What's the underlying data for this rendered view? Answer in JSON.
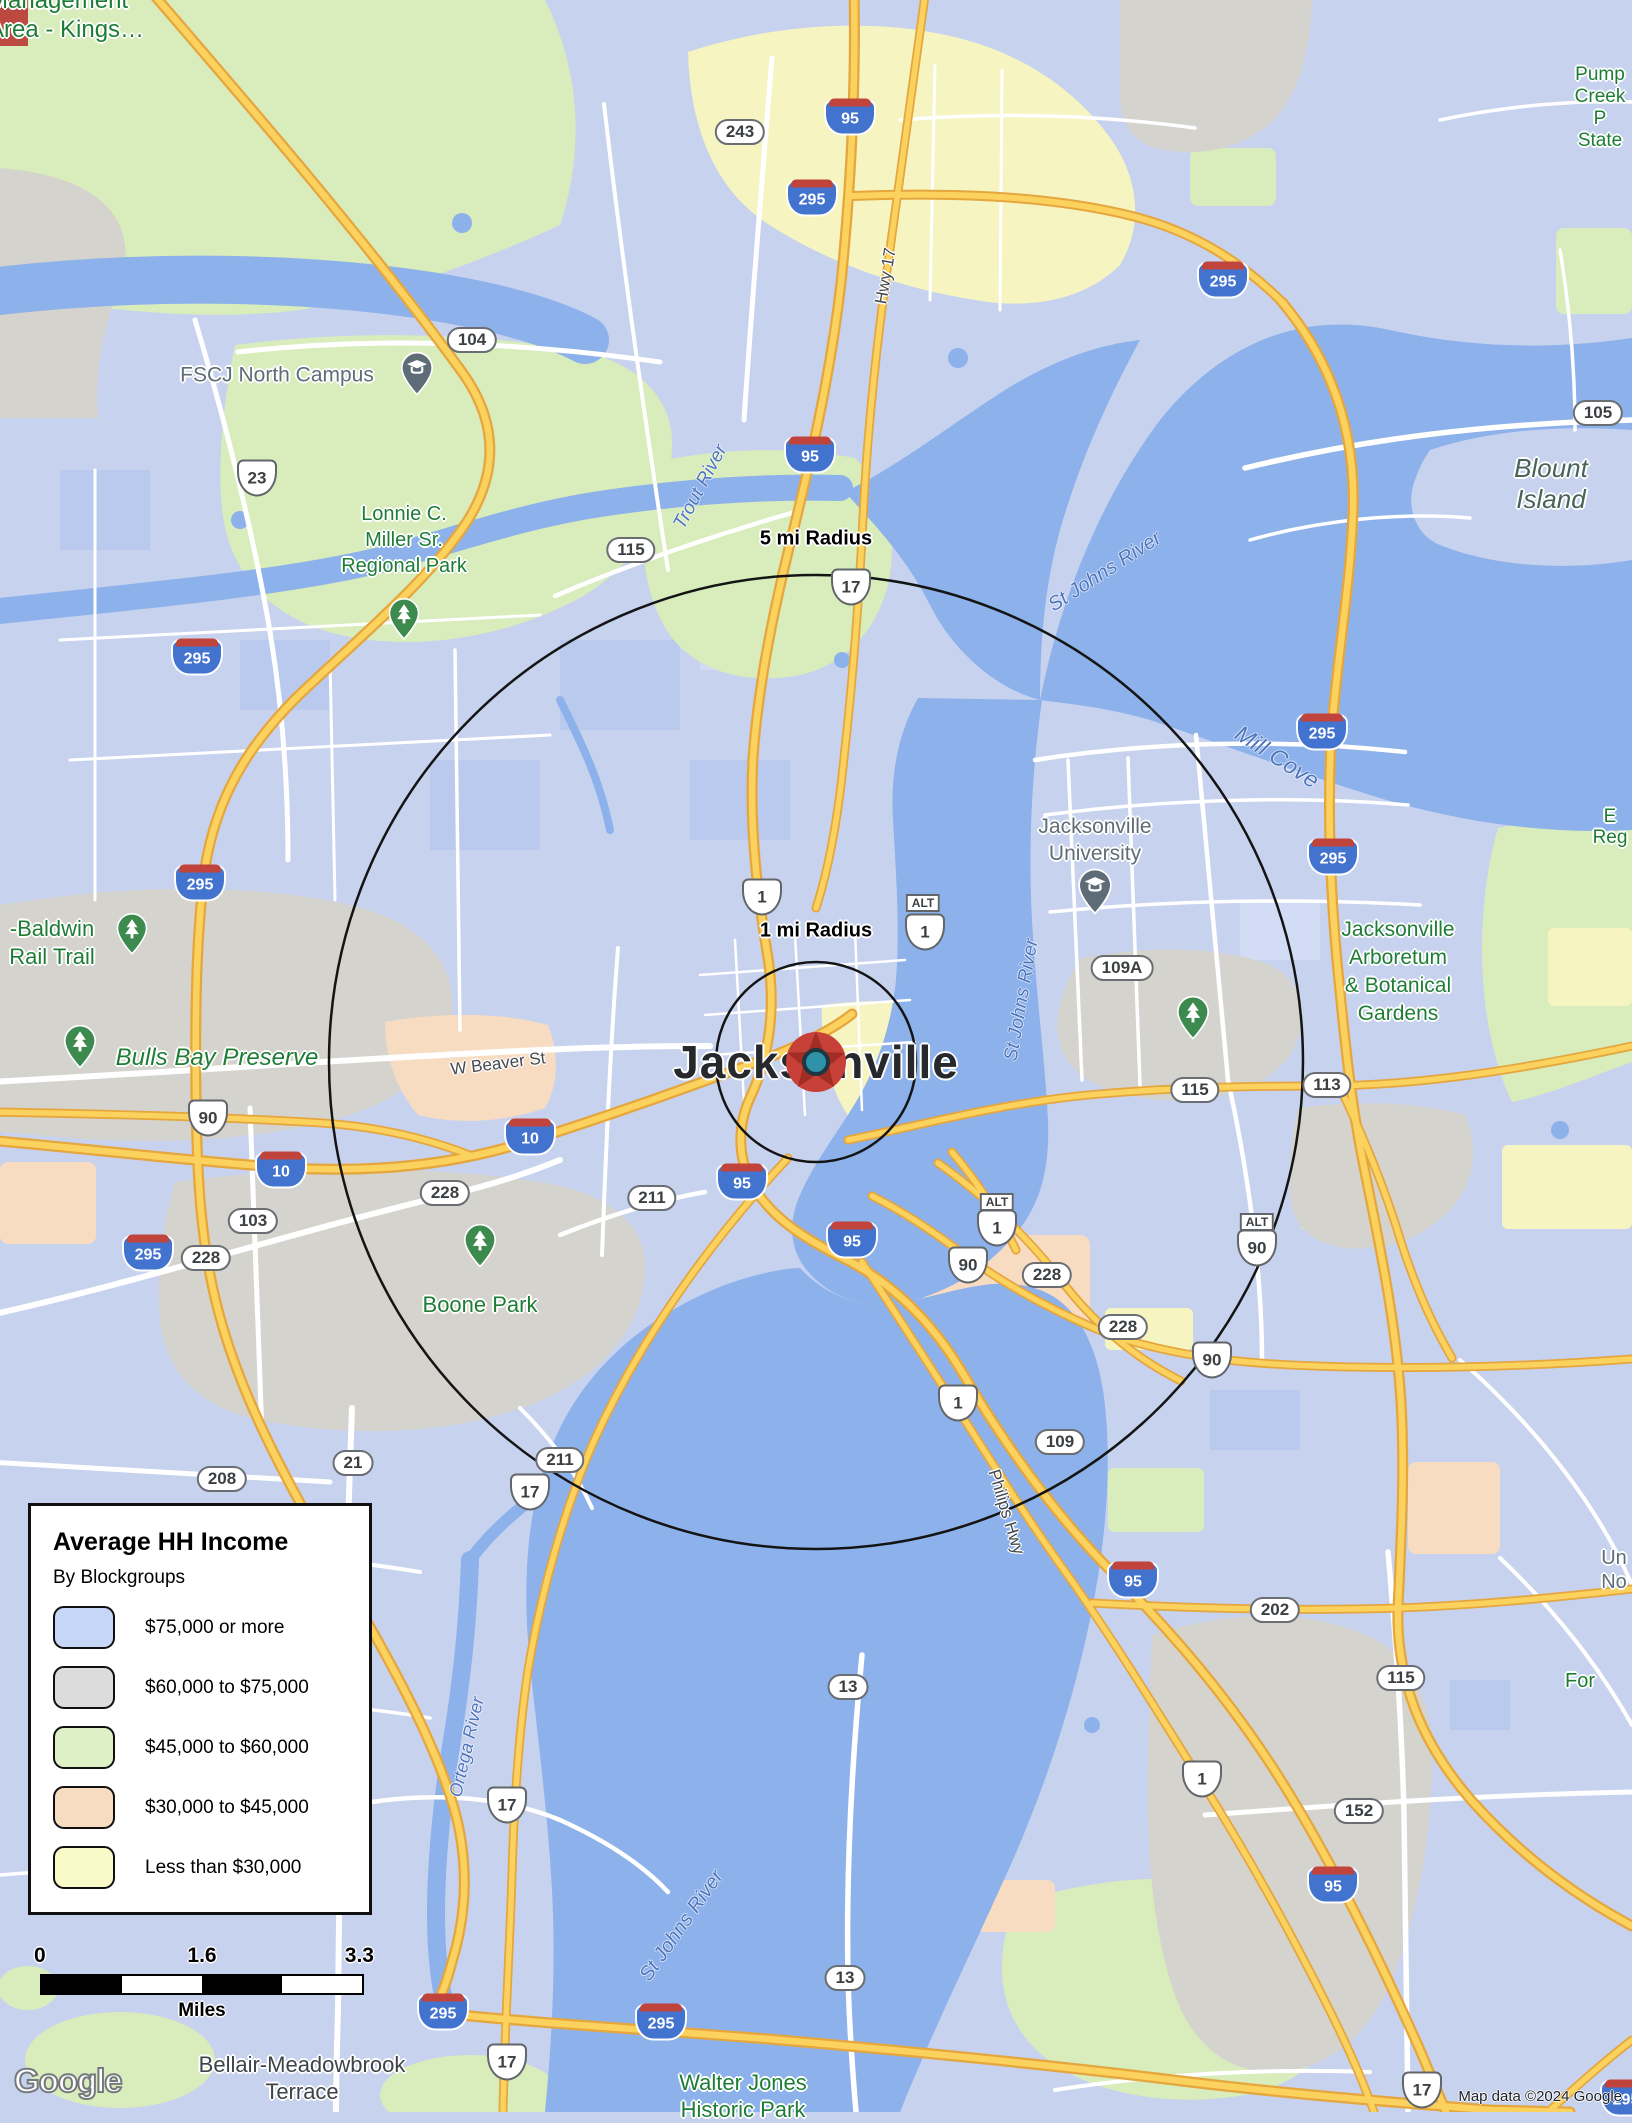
{
  "legend": {
    "title": "Average HH Income",
    "subtitle": "By Blockgroups",
    "items": [
      {
        "label": "$75,000 or more",
        "swatch_css": "background:#c5d6f7"
      },
      {
        "label": "$60,000 to $75,000",
        "swatch_css": "background:#dcdcdc"
      },
      {
        "label": "$45,000 to $60,000",
        "swatch_css": "background:#def0c6"
      },
      {
        "label": "$30,000 to $45,000",
        "swatch_css": "background:#f8dcc1"
      },
      {
        "label": "Less than $30,000",
        "swatch_css": "background:#fafac8"
      }
    ]
  },
  "scale": {
    "start": "0",
    "mid": "1.6",
    "end": "3.3",
    "unit": "Miles"
  },
  "attribution": "Map data ©2024 Google",
  "logo": "Google",
  "map": {
    "city": {
      "name": "Jacksonville"
    },
    "radius": {
      "inner": "1 mi Radius",
      "outer": "5 mi Radius"
    },
    "colors": {
      "water": "#8db1ea",
      "land": "#c7d2ef",
      "green": "#d8ecbc",
      "gray": "#d5d3cd",
      "peach": "#f7dcc2",
      "yellow": "#f6f4c0",
      "highway": "#fcd25e",
      "highway_casing": "#e5a63d",
      "interstate_blue": "#4273ce",
      "interstate_red": "#c0443b",
      "park_text": "#1e7d35",
      "water_text": "#4d74bd",
      "marker_red": "#c84138",
      "marker_teal": "#2e93a8"
    },
    "shields": {
      "interstate": [
        "95",
        "295",
        "295",
        "95",
        "295",
        "295",
        "295",
        "295",
        "10",
        "10",
        "95",
        "95",
        "295",
        "95",
        "95",
        "295",
        "295",
        "295"
      ],
      "us": [
        "23",
        "17",
        "1",
        "90",
        "1",
        "90",
        "90",
        "1",
        "1",
        "90",
        "1",
        "17",
        "17",
        "17",
        "17"
      ],
      "alt": [
        "ALT",
        "ALT",
        "ALT"
      ],
      "pill": [
        "243",
        "104",
        "115",
        "105",
        "109A",
        "115",
        "113",
        "103",
        "228",
        "228",
        "211",
        "228",
        "228",
        "109",
        "21",
        "208",
        "211",
        "13",
        "202",
        "115",
        "152",
        "13"
      ]
    },
    "places": [
      {
        "text": "Management\nArea - Kings…"
      },
      {
        "text": "FSCJ North Campus"
      },
      {
        "text": "Lonnie C.\nMiller Sr.\nRegional Park"
      },
      {
        "text": "-Baldwin\nRail Trail"
      },
      {
        "text": "Bulls Bay Preserve"
      },
      {
        "text": "Boone Park"
      },
      {
        "text": "Jacksonville\nUniversity"
      },
      {
        "text": "Jacksonville\nArboretum\n& Botanical\nGardens"
      },
      {
        "text": "Pump\nCreek P\nState"
      },
      {
        "text": "Blount Island"
      },
      {
        "text": "Walter Jones\nHistoric Park"
      },
      {
        "text": "Bellair-Meadowbrook\nTerrace"
      },
      {
        "text": "E\nReg"
      },
      {
        "text": "Un\nNo"
      },
      {
        "text": "For"
      }
    ],
    "water_labels": [
      {
        "text": "Trout River"
      },
      {
        "text": "St Johns River"
      },
      {
        "text": "Mill Cove"
      },
      {
        "text": "St Johns River"
      },
      {
        "text": "Ortega River"
      },
      {
        "text": "St Johns River"
      }
    ],
    "road_labels": [
      {
        "text": "W Beaver St"
      },
      {
        "text": "Hwy 17"
      },
      {
        "text": "Philips Hwy"
      }
    ]
  }
}
